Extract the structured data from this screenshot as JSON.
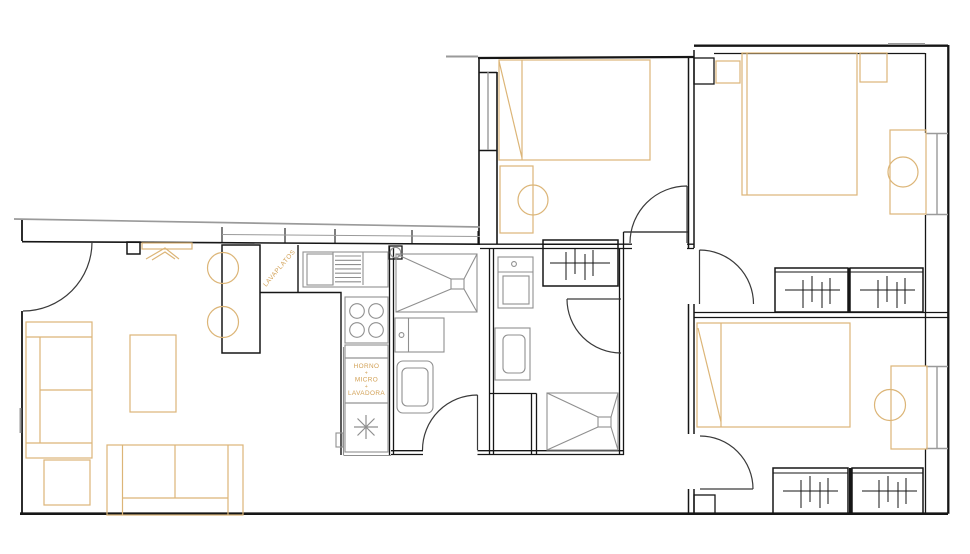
{
  "colors": {
    "background": "#ffffff",
    "wall": "#161616",
    "fixture": "#8f8f8f",
    "window": "#9a9a9a",
    "door": "#3a3a3a",
    "furniture": "#dcb577",
    "label": "#d2a156"
  },
  "labels": {
    "dishwasher_label": "LAVAPLATOS",
    "appliance_stack_lines": [
      "HORNO",
      "+",
      "MICRO",
      "+",
      "LAVADORA"
    ]
  },
  "symbols": [
    "door-swing",
    "window-glazing",
    "double-bed",
    "single-bed",
    "nightstand",
    "desk",
    "desk-chair",
    "wardrobe-hanging-rail",
    "closet",
    "sofa",
    "coffee-table",
    "side-table",
    "bar-counter",
    "bar-stool",
    "kitchen-sink",
    "dish-rack",
    "stove-burners",
    "fridge-snowflake",
    "water-heater",
    "shower-tray",
    "washbasin",
    "toilet",
    "duct-shaft",
    "column"
  ]
}
